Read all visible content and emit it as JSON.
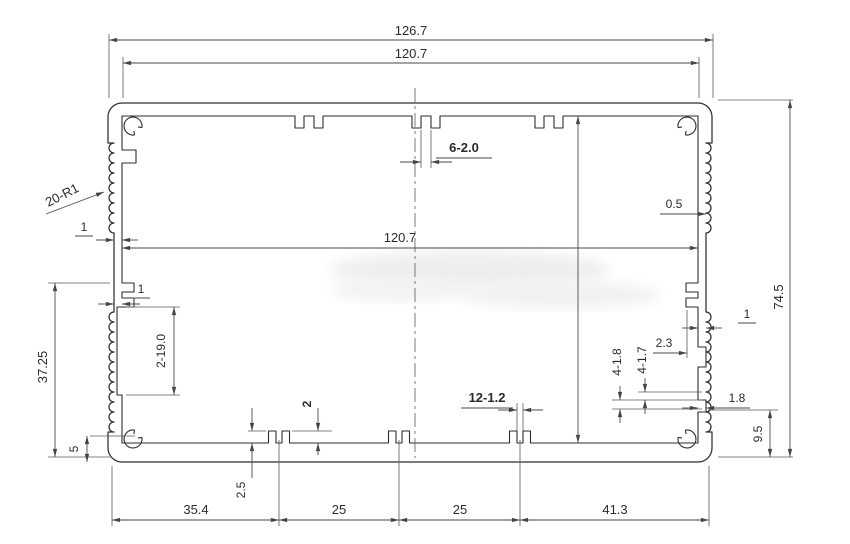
{
  "drawing": {
    "title": "aluminium-extrusion-profile-section",
    "units": "mm",
    "background": "#ffffff",
    "line_color": "#2e2e2e",
    "dim_color": "#4a4a4a",
    "dimensions": {
      "total_width": "126.7",
      "inner_width_top": "120.7",
      "inner_width_mid": "120.7",
      "overall_height": "74.5",
      "left_height": "37.25",
      "top_slots": "6-2.0",
      "corner_radius": "20-R1",
      "wall_thk_upper_left": "1",
      "wall_thk_lower_left": "1",
      "wall_thk_right": "1",
      "flute_offset": "0.5",
      "side_slot": "2-19.0",
      "boss_gap": "2.3",
      "notches_17": "4-1.7",
      "notches_18": "4-1.8",
      "notch_depth": "1.8",
      "rib_height": "2",
      "bottom_slots": "12-1.2",
      "corner_offset_right": "9.5",
      "corner_offset_left": "5",
      "bottom_rib": "2.5",
      "bottom_chain": [
        "35.4",
        "25",
        "25",
        "41.3"
      ]
    }
  }
}
